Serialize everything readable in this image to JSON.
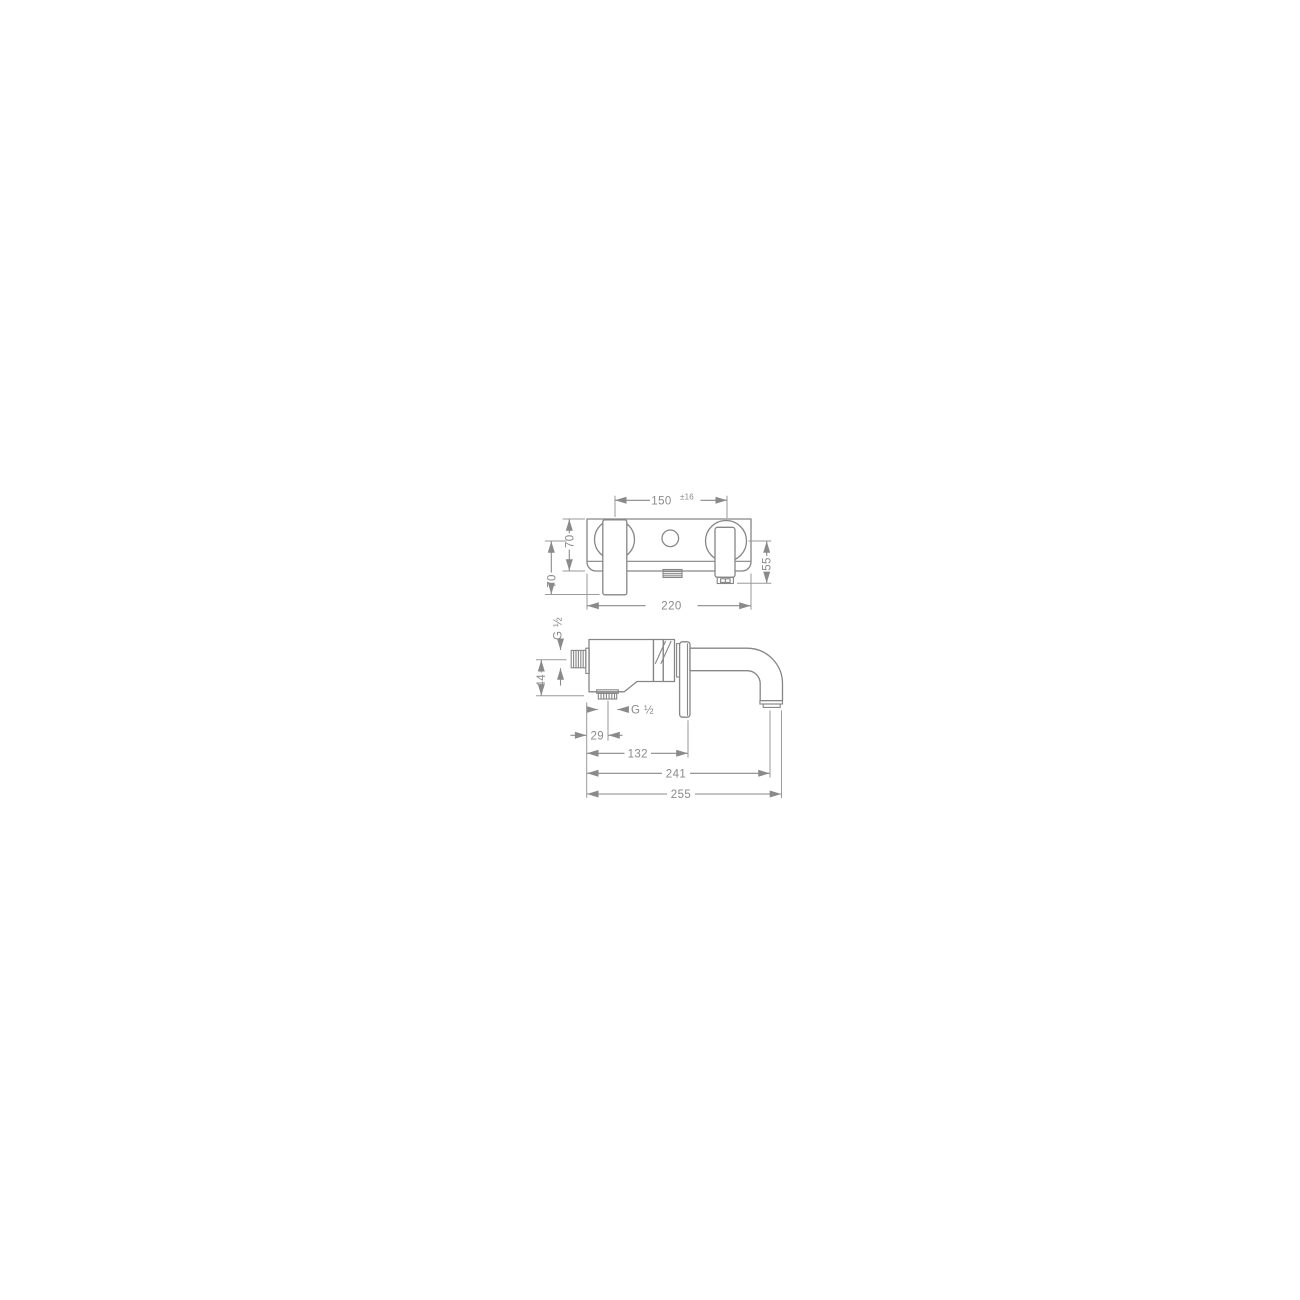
{
  "drawing": {
    "type": "technical-dimension-drawing",
    "views": [
      "front-view",
      "side-view"
    ],
    "colors": {
      "background": "#ffffff",
      "line": "#868686",
      "text": "#8a8a8a"
    },
    "front_view": {
      "hole_spacing": "150",
      "hole_spacing_tolerance": "±16",
      "plate_height": "70",
      "lever_drop": "70",
      "handle_drop": "55",
      "overall_width": "220"
    },
    "side_view": {
      "inlet_thread": "G ½",
      "inlet_drop": "44",
      "outlet_thread": "G ½",
      "outlet_offset": "29",
      "rosette_depth": "132",
      "spout_center_reach": "241",
      "spout_reach": "255"
    }
  }
}
